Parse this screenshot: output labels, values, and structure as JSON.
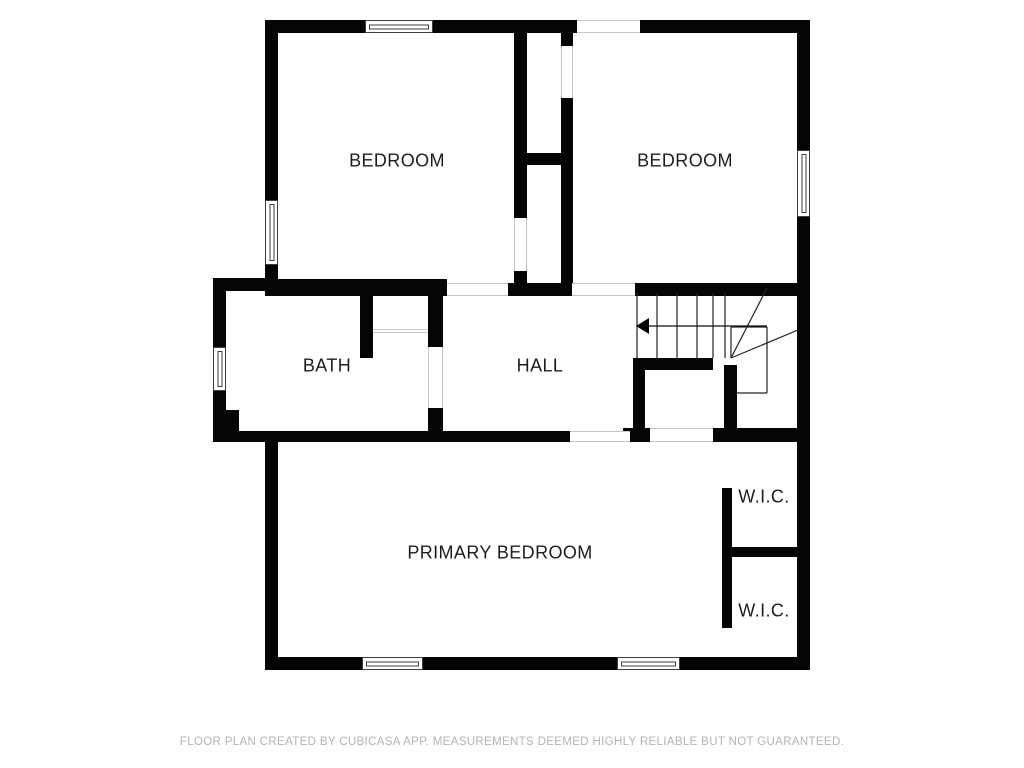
{
  "title": "Second floor plan",
  "rooms": {
    "bedroom_left": {
      "label": "BEDROOM"
    },
    "bedroom_right": {
      "label": "BEDROOM"
    },
    "bath": {
      "label": "BATH"
    },
    "hall": {
      "label": "HALL"
    },
    "primary_bedroom": {
      "label": "PRIMARY BEDROOM"
    },
    "wic_top": {
      "label": "W.I.C."
    },
    "wic_bottom": {
      "label": "W.I.C."
    }
  },
  "stairs": {
    "icon": "left-arrow",
    "description": "staircase with winder treads and direction arrow pointing left into hall"
  },
  "footer": {
    "disclaimer": "FLOOR PLAN CREATED BY CUBICASA APP. MEASUREMENTS DEEMED HIGHLY RELIABLE BUT NOT GUARANTEED."
  },
  "colors": {
    "wall": "#050505",
    "background": "#ffffff",
    "label": "#1d1d1d",
    "footer_text": "#b3b3b3",
    "opening_line": "#c6c6c6",
    "stair_line": "#222222"
  }
}
